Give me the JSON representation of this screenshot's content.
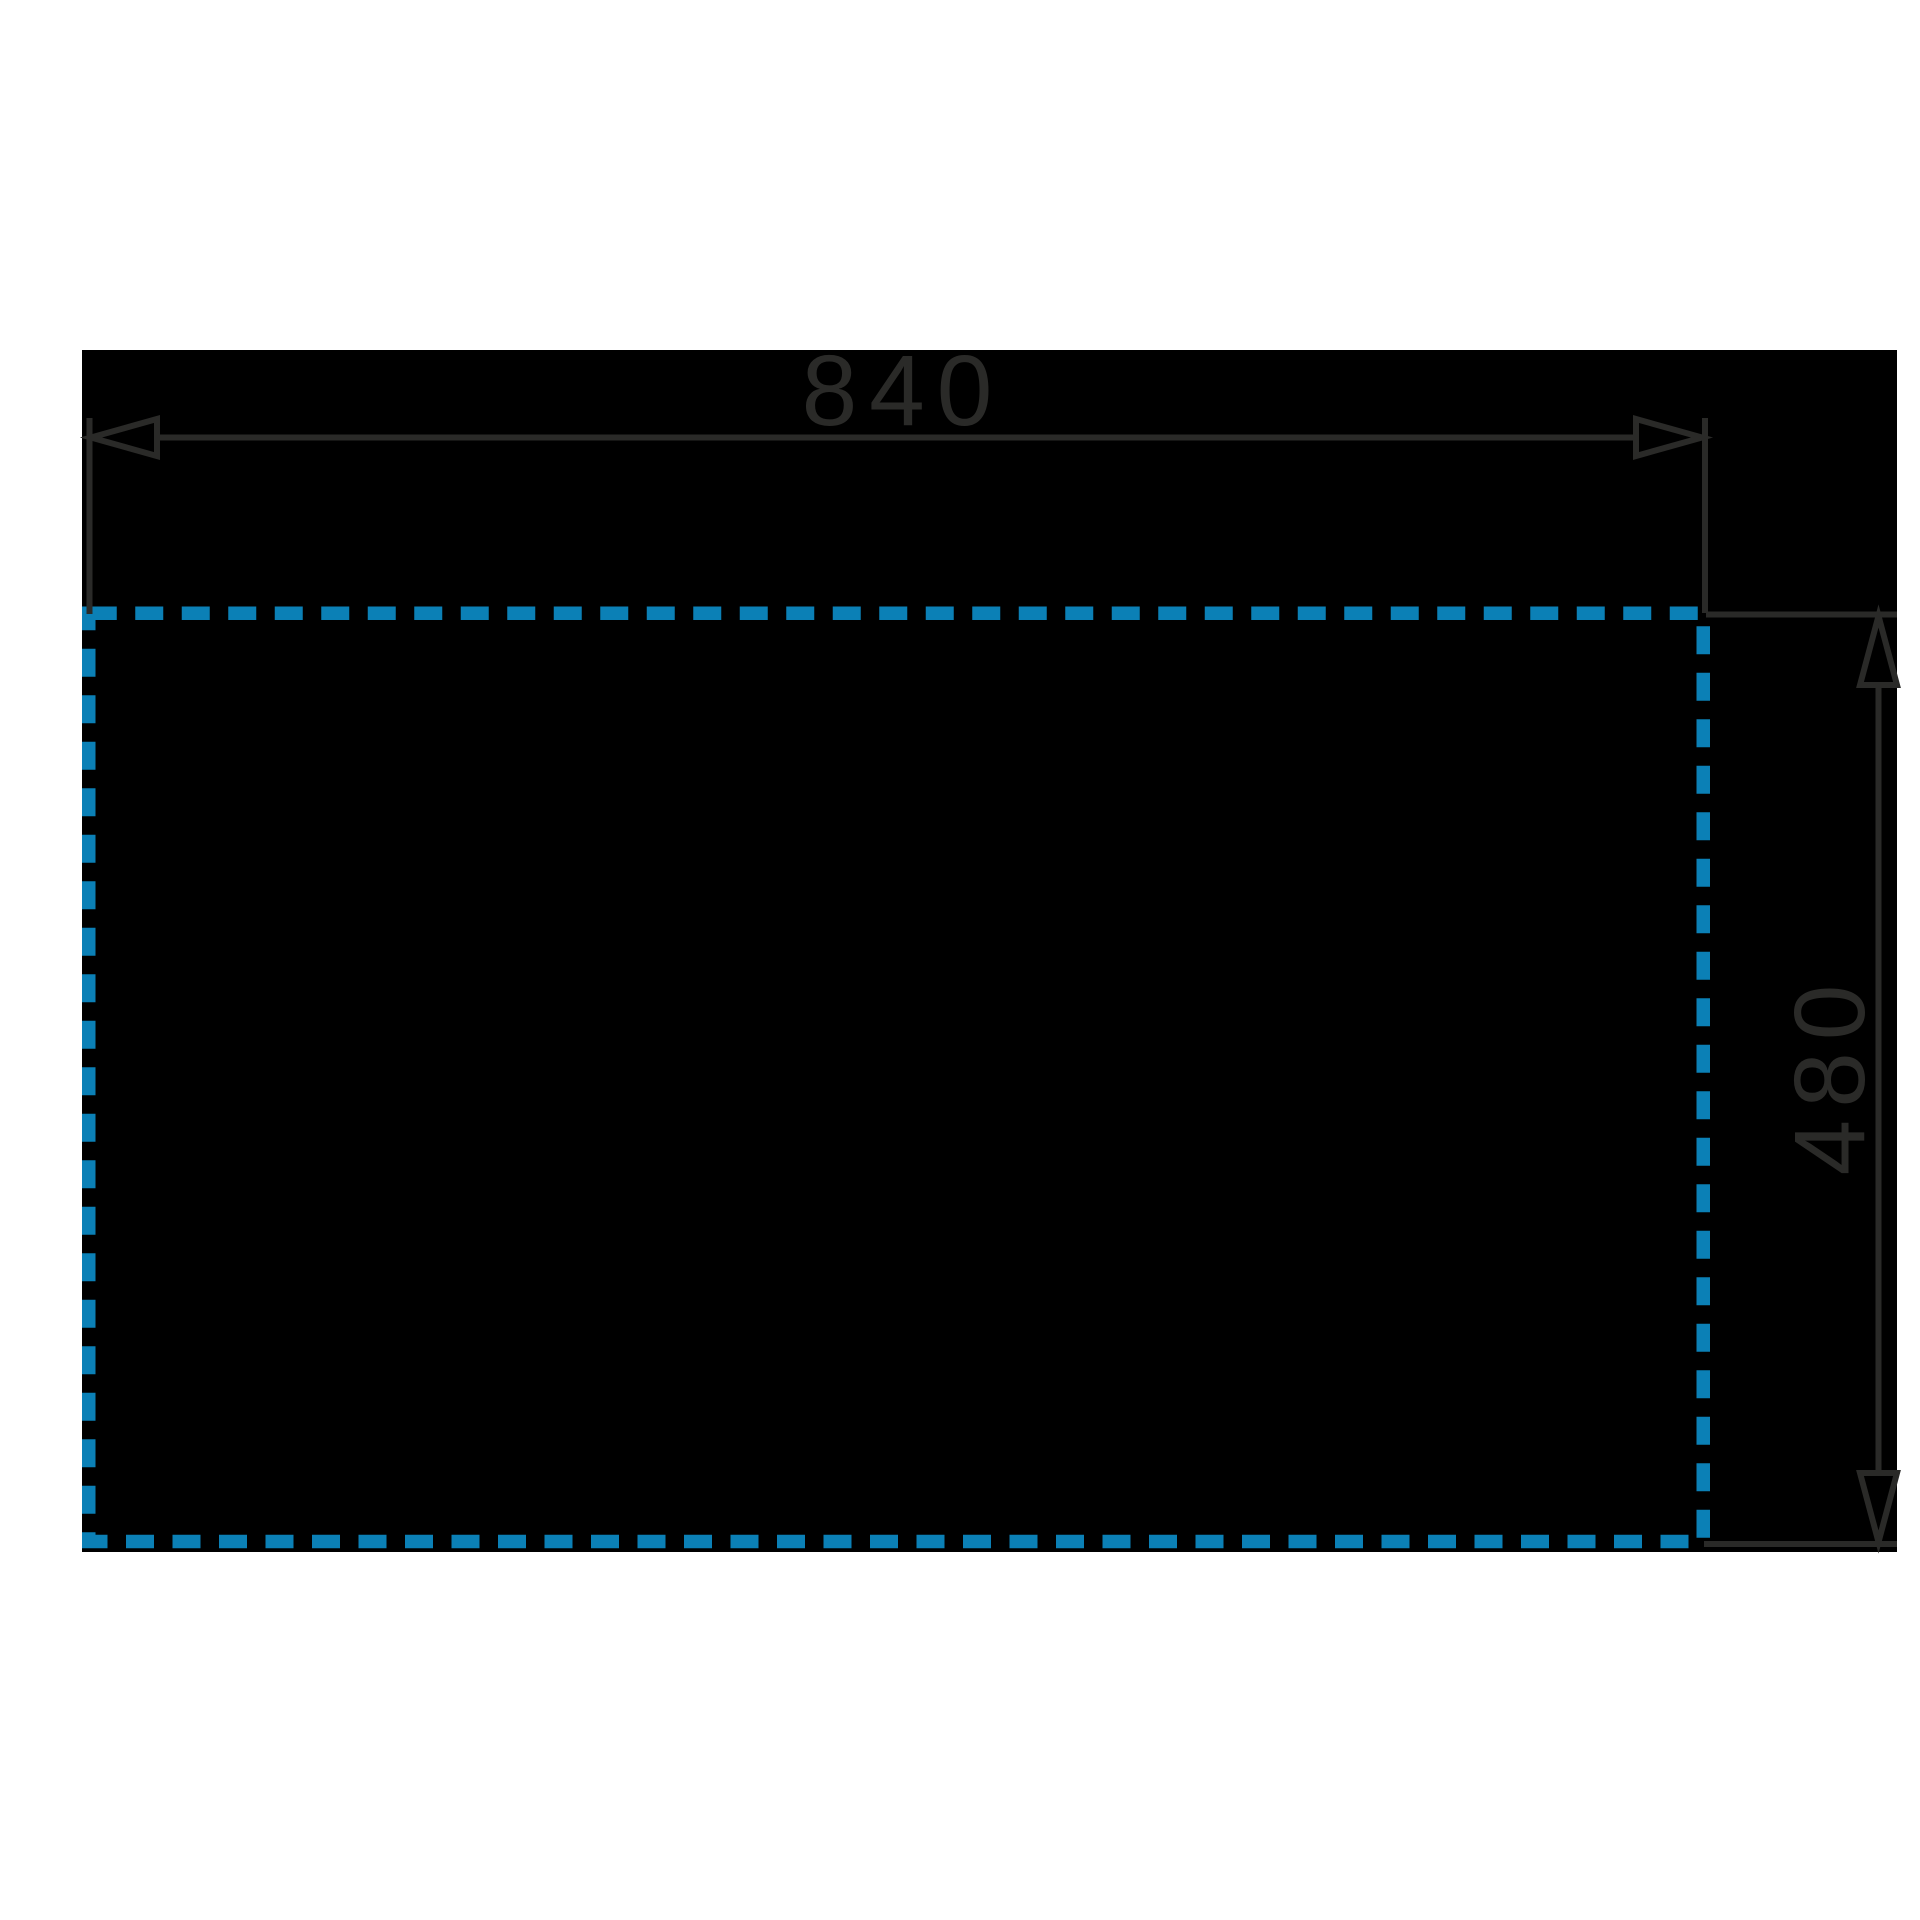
{
  "drawing": {
    "title": "installation-cutout-dimension-drawing",
    "dimensions": {
      "width": {
        "label": "840"
      },
      "height": {
        "label": "480"
      }
    }
  },
  "colors": {
    "page_background": "#ffffff",
    "panel_black": "#000000",
    "drawing_stroke": "#2a2a28",
    "cutout_dash_blue": "#0b80b6"
  }
}
